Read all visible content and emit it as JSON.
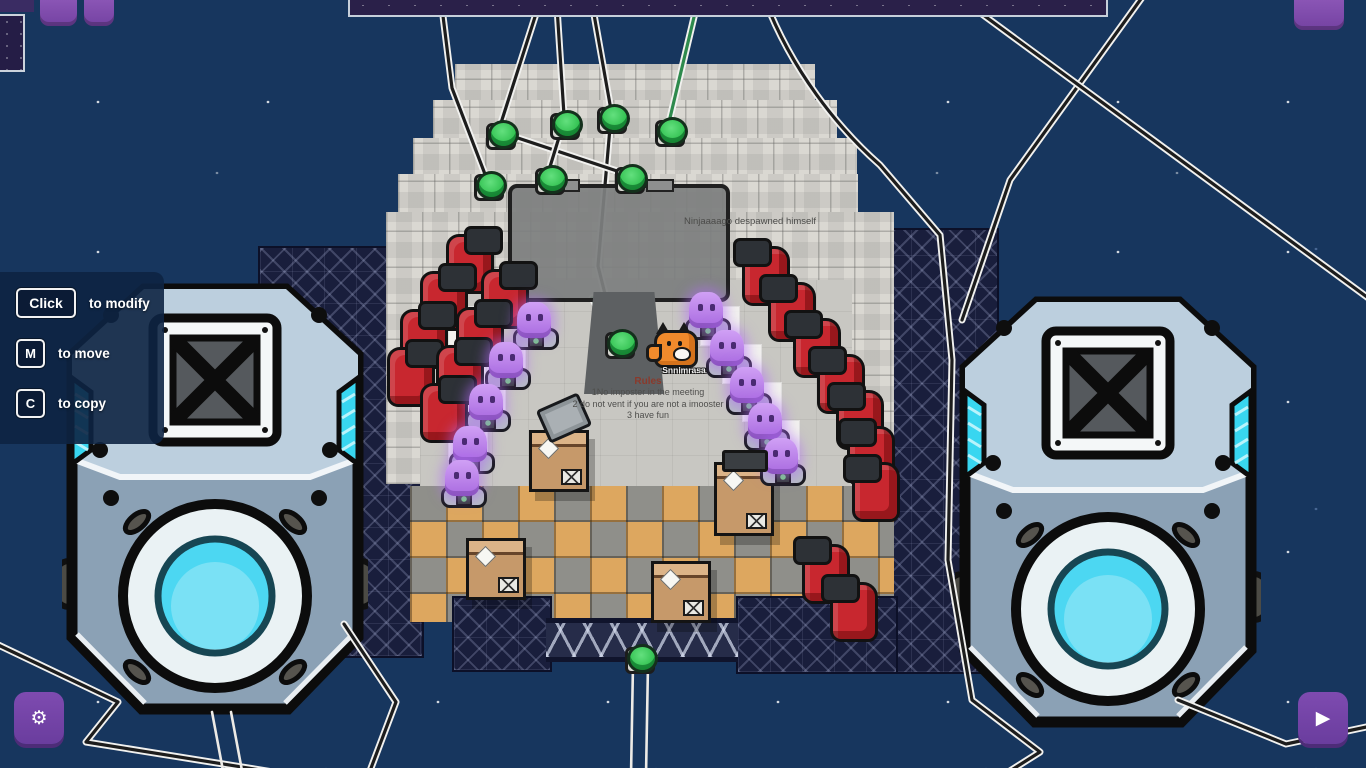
{
  "hud": {
    "hint_panel": {
      "rows": [
        {
          "key": "Click",
          "label": "to modify"
        },
        {
          "key": "M",
          "label": "to move"
        },
        {
          "key": "C",
          "label": "to copy"
        }
      ]
    },
    "settings_button": {
      "icon": "gear-icon",
      "glyph": "⚙"
    },
    "play_button": {
      "icon": "play-icon",
      "glyph": "▶"
    }
  },
  "feed": {
    "message": "Ninjaaaago despawned himself"
  },
  "scene": {
    "player_name": "Snnimrasa",
    "rules_sign": {
      "title": "Rules",
      "lines": [
        "1No imposter in the meeting",
        "2 do not vent if you are not a imooster",
        "3 have fun"
      ]
    }
  },
  "colors": {
    "space_blue": "#17365e",
    "accent_purple": "#7b46ab",
    "button_green": "#3ecb59",
    "chair_red": "#c8272f",
    "crew_purple": "#bb85ea",
    "speaker_cyan": "#4fd8f2"
  }
}
